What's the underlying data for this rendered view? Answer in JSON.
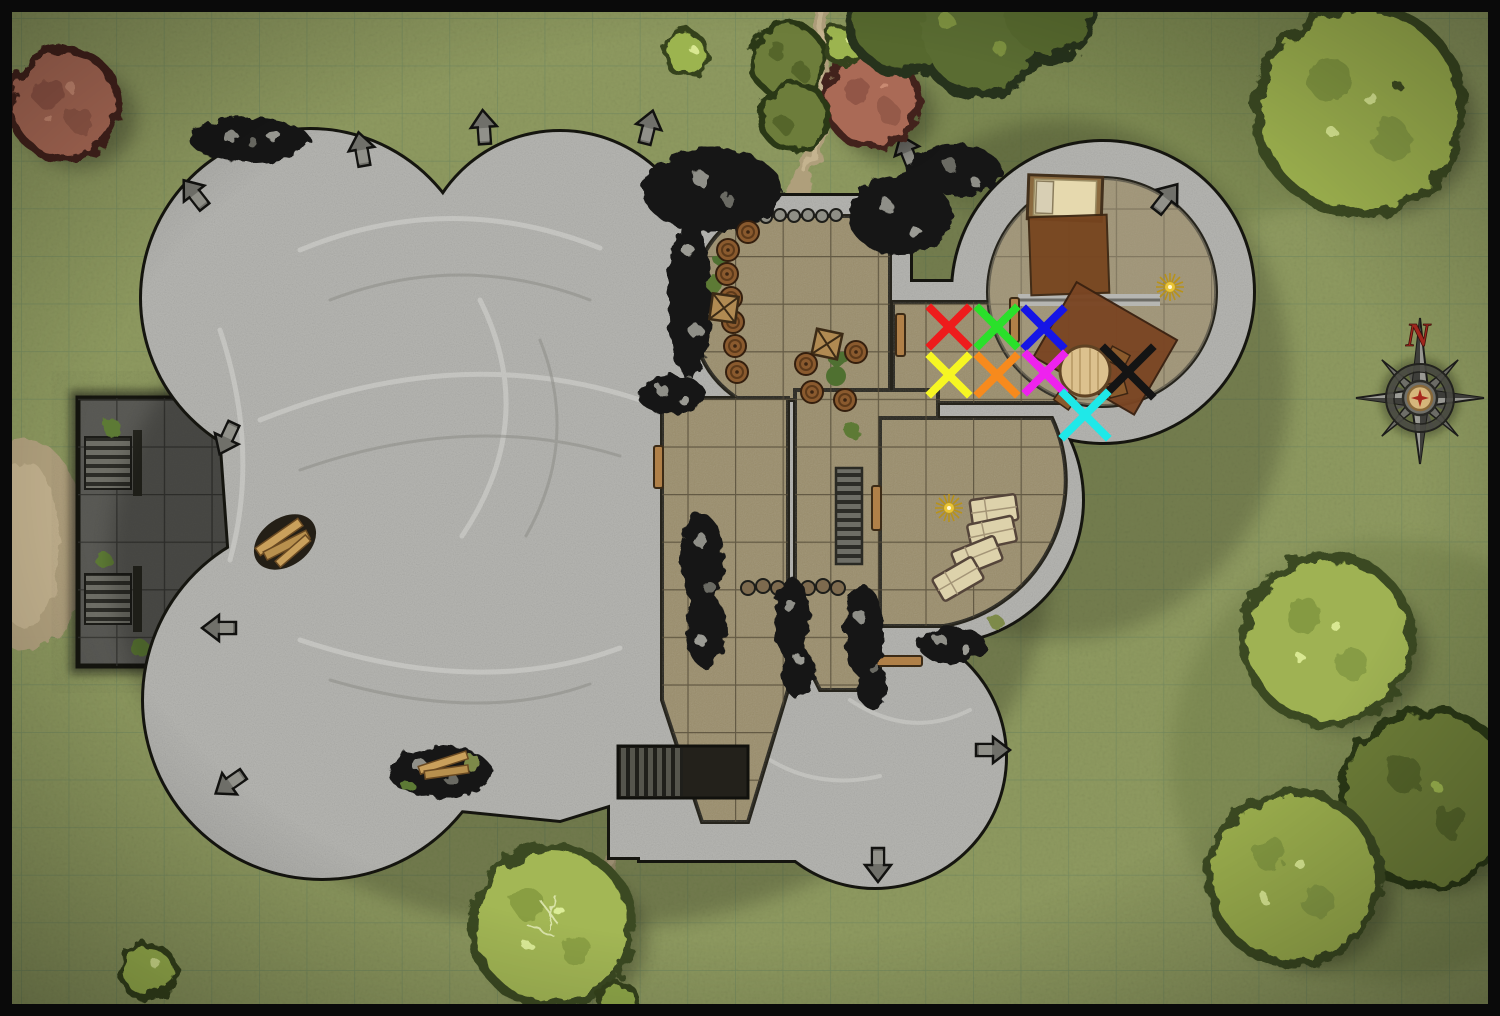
{
  "map": {
    "type": "top-down fantasy battle map",
    "theme": "ruined stone keep with round towers on grassland",
    "border_color": "#0a0a0a",
    "grass_color": "#8e9a60",
    "stone_color": "#b6b6b2",
    "floor_color": "#9a8d6b",
    "terrace_color": "#5a5a55",
    "grid": {
      "cell_px": 47.6,
      "offset_x": 21,
      "offset_y": 18,
      "line_color": "#647f5c"
    }
  },
  "compass": {
    "label": "N",
    "x": 1420,
    "y": 398,
    "letter_color": "#a5281e"
  },
  "marks": [
    {
      "id": "red-x",
      "color": "#ee1c1c",
      "x": 949,
      "y": 327,
      "size": 36,
      "stroke": 8
    },
    {
      "id": "green-x",
      "color": "#2ae02a",
      "x": 997,
      "y": 327,
      "size": 36,
      "stroke": 8
    },
    {
      "id": "blue-x",
      "color": "#1515e6",
      "x": 1044,
      "y": 328,
      "size": 36,
      "stroke": 8
    },
    {
      "id": "yellow-x",
      "color": "#f6f623",
      "x": 949,
      "y": 375,
      "size": 36,
      "stroke": 8
    },
    {
      "id": "orange-x",
      "color": "#f78a1d",
      "x": 997,
      "y": 375,
      "size": 36,
      "stroke": 8
    },
    {
      "id": "magenta-x",
      "color": "#ee22ee",
      "x": 1045,
      "y": 373,
      "size": 36,
      "stroke": 8
    },
    {
      "id": "black-x",
      "color": "#141414",
      "x": 1128,
      "y": 372,
      "size": 46,
      "stroke": 8
    },
    {
      "id": "cyan-x",
      "color": "#1fe8e8",
      "x": 1085,
      "y": 415,
      "size": 42,
      "stroke": 8
    }
  ],
  "objects": [
    {
      "name": "bed",
      "x": 1064,
      "y": 198
    },
    {
      "name": "bedroom-rug",
      "x": 1068,
      "y": 254
    },
    {
      "name": "table-rug",
      "x": 1105,
      "y": 347
    },
    {
      "name": "round-table",
      "x": 1085,
      "y": 371
    },
    {
      "name": "gold-sparkle-bedroom",
      "x": 1170,
      "y": 287
    },
    {
      "name": "gold-sparkle-chapel",
      "x": 949,
      "y": 508
    },
    {
      "name": "coffins",
      "x": 975,
      "y": 545,
      "count": 4
    },
    {
      "name": "barrels-west-wall",
      "x": 730,
      "y": 290
    },
    {
      "name": "barrels-southeast",
      "x": 830,
      "y": 375
    },
    {
      "name": "crates",
      "x": 726,
      "y": 308
    },
    {
      "name": "wood-debris-terrace",
      "x": 285,
      "y": 542
    },
    {
      "name": "wood-debris-courtyard",
      "x": 445,
      "y": 770
    },
    {
      "name": "terrace-stairs",
      "x": 108,
      "y": 463,
      "count": 2
    },
    {
      "name": "cellar-stairs",
      "x": 655,
      "y": 772
    },
    {
      "name": "hall-stairs",
      "x": 849,
      "y": 516
    }
  ]
}
